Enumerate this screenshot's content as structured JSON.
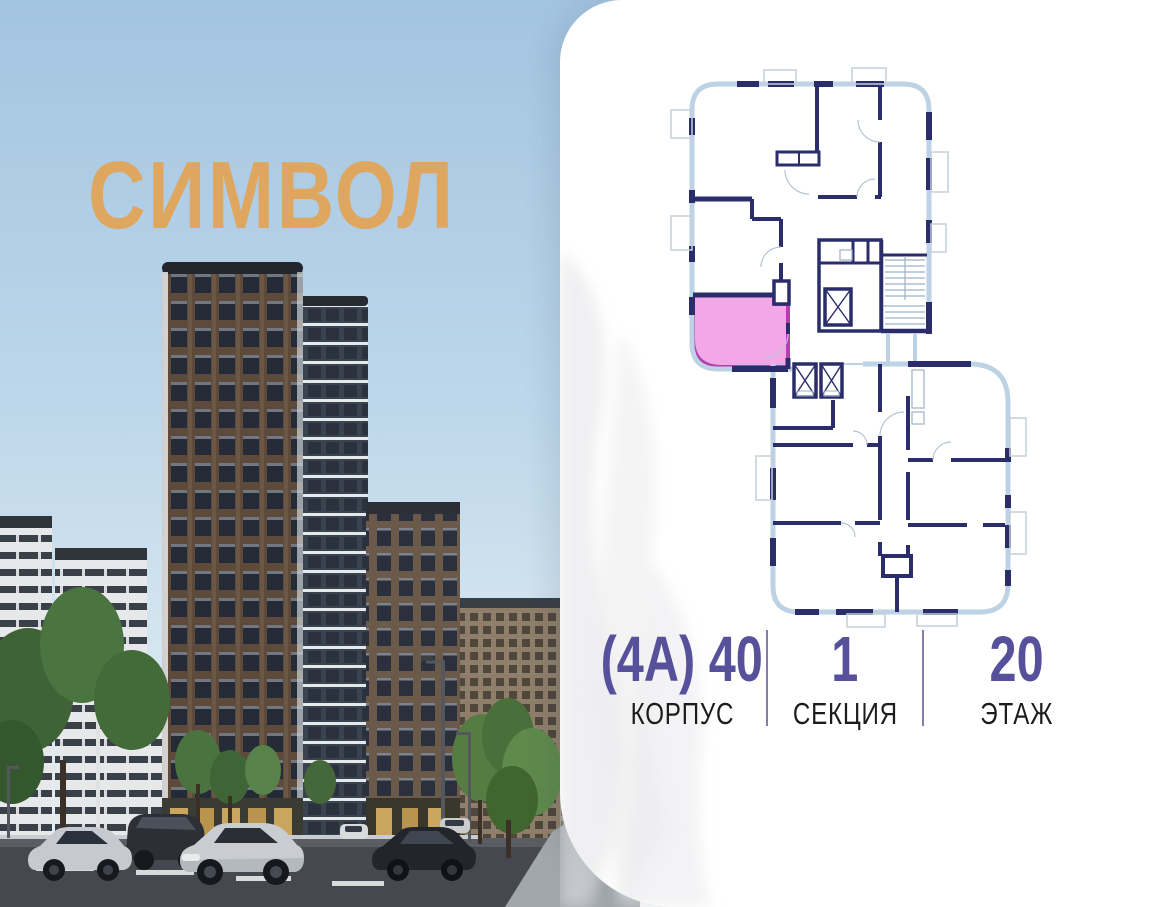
{
  "logo": {
    "text": "СИМВОЛ",
    "color": "#dfa660"
  },
  "photo": {
    "description": "residential towers street view",
    "sky_color": "#a9cbe3",
    "elements": [
      "main-brick-tower",
      "glass-tower",
      "left-white-towers",
      "right-brick-tower",
      "background-buildings",
      "trees",
      "road",
      "cars",
      "street-lamps"
    ]
  },
  "floor_plan": {
    "wall_color": "#2b2d6b",
    "window_wall_color": "#bdd2e4",
    "balcony_line_color": "#c6cfd9",
    "highlighted_unit": {
      "fill": "#f2a8e7",
      "border": "#b13fae",
      "state": "selected"
    }
  },
  "info": {
    "accent_color": "#57519b",
    "divider_color": "#827da9",
    "items": [
      {
        "value": "(4А) 40",
        "label": "КОРПУС"
      },
      {
        "value": "1",
        "label": "СЕКЦИЯ"
      },
      {
        "value": "20",
        "label": "ЭТАЖ"
      }
    ]
  }
}
